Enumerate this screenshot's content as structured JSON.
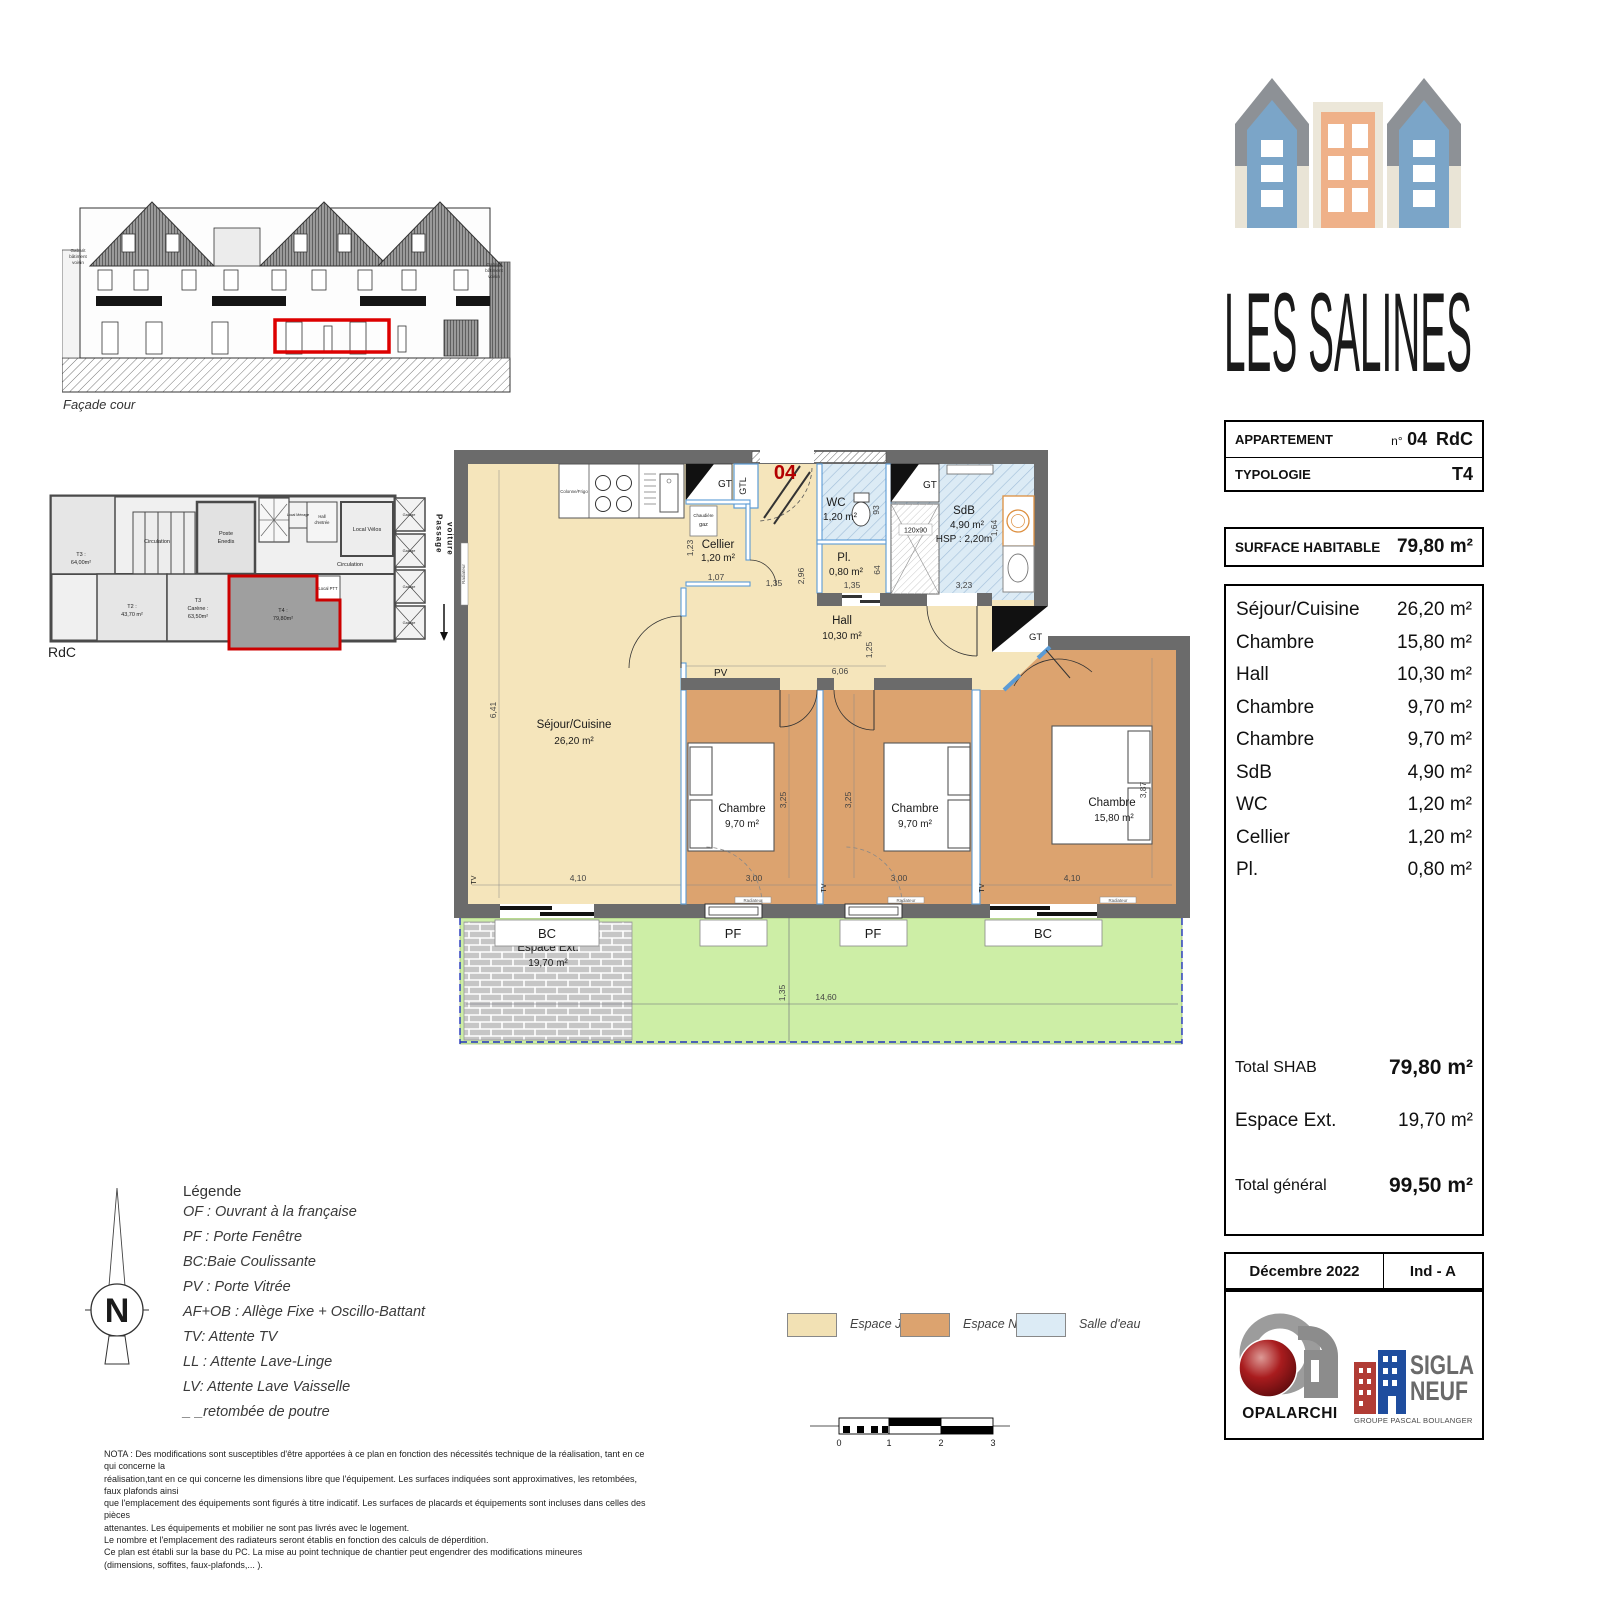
{
  "project": {
    "name": "LES SALINES"
  },
  "colors": {
    "wall": "#6b6b6b",
    "interior_wall": "#5b9bd5",
    "espace_jour": "#f5e5bb",
    "espace_nuit": "#dca36f",
    "salle_eau": "#dcebf5",
    "espace_ext": "#cdeea6",
    "highlight_red": "#cc0000",
    "logo_blue": "#2d7396"
  },
  "facade": {
    "caption": "Façade cour",
    "gabarit": "Gabarit bâtiment voisin"
  },
  "keyplan": {
    "caption": "RdC",
    "t3a_name": "T3 :",
    "t3a_area": "64,00m²",
    "t2_name": "T2 :",
    "t2_area": "43,70 m²",
    "t3b_name": "T3",
    "t3b_line2": "Carène :",
    "t3b_area": "63,50m²",
    "t4_name": "T4 :",
    "t4_area": "79,80m²",
    "circulation": "Circulation",
    "poste_line1": "Poste",
    "poste_line2": "Enedis",
    "local_velos": "Local Vélos",
    "local_ptt": "Local PTT",
    "local_menage": "Local Ménage",
    "hall_line1": "Hall",
    "hall_line2": "d'entrée",
    "passage_line1": "Passage",
    "passage_line2": "voiture",
    "garage": "Garage"
  },
  "info_table": {
    "row1_label": "APPARTEMENT",
    "no_prefix": "n°",
    "no_value": "04",
    "floor": "RdC",
    "row2_label": "TYPOLOGIE",
    "typology": "T4"
  },
  "surface_box": {
    "label": "SURFACE HABITABLE",
    "value": "79,80 m²"
  },
  "rooms_list": {
    "items": [
      {
        "name": "Séjour/Cuisine",
        "area": "26,20 m²"
      },
      {
        "name": "Chambre",
        "area": "15,80 m²"
      },
      {
        "name": "Hall",
        "area": "10,30 m²"
      },
      {
        "name": "Chambre",
        "area": "9,70 m²"
      },
      {
        "name": "Chambre",
        "area": "9,70 m²"
      },
      {
        "name": "SdB",
        "area": "4,90 m²"
      },
      {
        "name": "WC",
        "area": "1,20 m²"
      },
      {
        "name": "Cellier",
        "area": "1,20 m²"
      },
      {
        "name": "Pl.",
        "area": "0,80 m²"
      }
    ],
    "total_shab_label": "Total SHAB",
    "total_shab_value": "79,80 m²",
    "espace_ext_label": "Espace Ext.",
    "espace_ext_value": "19,70 m²",
    "total_general_label": "Total général",
    "total_general_value": "99,50 m²"
  },
  "title_block": {
    "date": "Décembre 2022",
    "index": "Ind - A"
  },
  "logos": {
    "opalarchi": "OPALARCHI",
    "sigla_line1": "SIGLA",
    "sigla_line2": "NEUF",
    "sigla_sub": "GROUPE PASCAL BOULANGER"
  },
  "plan": {
    "apartment_number": "04",
    "sejour_name": "Séjour/Cuisine",
    "sejour_area": "26,20 m²",
    "cellier_name": "Cellier",
    "cellier_area": "1,20 m²",
    "chaudiere_line1": "Chaudière",
    "chaudiere_line2": "gaz",
    "wc_name": "WC",
    "wc_area": "1,20 m²",
    "pl_name": "Pl.",
    "pl_area": "0,80 m²",
    "sdb_name": "SdB",
    "sdb_area": "4,90 m²",
    "sdb_hsp": "HSP : 2,20m",
    "shower_size": "120x90",
    "hall_name": "Hall",
    "hall_area": "10,30 m²",
    "ch1_name": "Chambre",
    "ch1_area": "9,70 m²",
    "ch2_name": "Chambre",
    "ch2_area": "9,70 m²",
    "ch3_name": "Chambre",
    "ch3_area": "15,80 m²",
    "ext_name": "Espace Ext.",
    "ext_area": "19,70 m²",
    "gt": "GT",
    "gtl": "GTL",
    "pv": "PV",
    "bc": "BC",
    "pf": "PF",
    "tv": "TV",
    "radiateur": "Radiateur",
    "colonne_frigo": "Colonne/Frigo",
    "dims": {
      "d641": "6,41",
      "d123": "1,23",
      "d107": "1,07",
      "d135": "1,35",
      "d296": "2,96",
      "d64": "64",
      "d93": "93",
      "d323": "3,23",
      "d164": "1,64",
      "d606": "6,06",
      "d125": "1,25",
      "d325": "3,25",
      "d387": "3,87",
      "d410": "4,10",
      "d300": "3,00",
      "d1460": "14,60"
    }
  },
  "legend": {
    "title": "Légende",
    "lines": [
      "OF : Ouvrant à la française",
      "PF : Porte Fenêtre",
      "BC:Baie Coulissante",
      "PV : Porte Vitrée",
      "AF+OB : Allège Fixe + Oscillo-Battant",
      "TV: Attente TV",
      "LL : Attente Lave-Linge",
      "LV: Attente Lave Vaisselle",
      "_ _retombée de poutre"
    ]
  },
  "color_legend": {
    "items": [
      {
        "label": "Espace Jour",
        "color": "#f2e1b4"
      },
      {
        "label": "Espace Nuit",
        "color": "#dca36f"
      },
      {
        "label": "Salle d'eau",
        "color": "#dcebf5"
      }
    ]
  },
  "scalebar": {
    "ticks": [
      "0",
      "1",
      "2",
      "3"
    ]
  },
  "nota": {
    "lines": [
      "NOTA : Des modifications sont susceptibles d'être apportées à ce plan en fonction des nécessités technique de la réalisation, tant en ce qui concerne la",
      "réalisation,tant en ce qui concerne les dimensions libre que l'équipement. Les surfaces indiquées sont approximatives, les retombées, faux plafonds ainsi",
      "que l'emplacement des équipements sont figurés à titre indicatif. Les surfaces de placards et équipements sont incluses dans celles des pièces",
      "attenantes. Les équipements et mobilier ne sont pas livrés avec le logement.",
      "Le nombre et l'emplacement des radiateurs seront établis en fonction des calculs de déperdition.",
      "Ce plan est établi sur la base du PC. La mise au point technique de chantier peut engendrer des modifications mineures",
      "(dimensions, soffites, faux-plafonds,... )."
    ]
  }
}
